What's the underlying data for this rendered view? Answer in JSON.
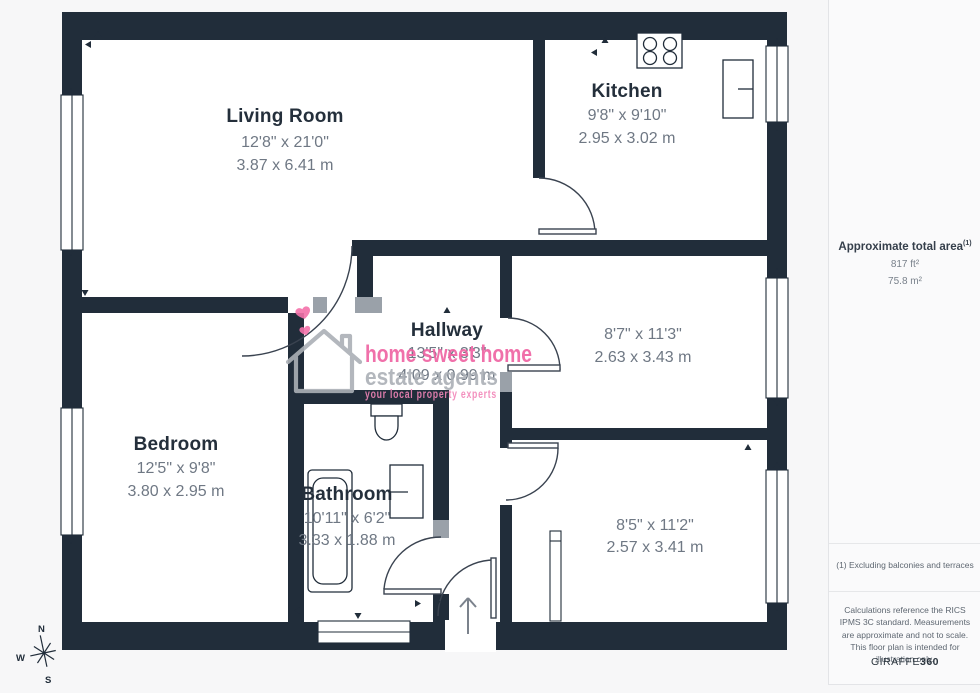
{
  "colors": {
    "wall": "#212d3a",
    "background": "#f7f7f8",
    "floor": "#ffffff",
    "dim_text": "#6f7884",
    "label_text": "#242f3b",
    "watermark_pink": "#ef61a1",
    "watermark_gray": "#abb0b6",
    "tagline_pink": "#f285b8"
  },
  "rooms": {
    "living_room": {
      "name": "Living Room",
      "imperial": "12'8\" x 21'0\"",
      "metric": "3.87 x 6.41 m"
    },
    "kitchen": {
      "name": "Kitchen",
      "imperial": "9'8\" x 9'10\"",
      "metric": "2.95 x 3.02 m"
    },
    "hallway": {
      "name": "Hallway",
      "imperial": "13'5\" x 3'3\"",
      "metric": "4.09 x 0.99 m"
    },
    "bedroom": {
      "name": "Bedroom",
      "imperial": "12'5\" x 9'8\"",
      "metric": "3.80 x 2.95 m"
    },
    "bathroom": {
      "name": "Bathroom",
      "imperial": "10'11\" x 6'2\"",
      "metric": "3.33 x 1.88 m"
    },
    "room_top_right": {
      "imperial": "8'7\" x 11'3\"",
      "metric": "2.63 x 3.43 m"
    },
    "room_bottom_right": {
      "imperial": "8'5\" x 11'2\"",
      "metric": "2.57 x 3.41 m"
    }
  },
  "watermark": {
    "brand_line1": "home sweet home",
    "brand_line2": "estate agents",
    "tagline": "your local property experts"
  },
  "compass": {
    "north": "N",
    "west": "W",
    "south": "S"
  },
  "sidebar": {
    "area_title": "Approximate total area",
    "area_note_ref": "(1)",
    "area_imperial": "817 ft²",
    "area_metric": "75.8 m²",
    "footnote": "(1) Excluding balconies and terraces",
    "disclaimer": "Calculations reference the RICS IPMS 3C standard. Measurements are approximate and not to scale. This floor plan is intended for illustration only.",
    "brand_name": "GIRAFFE",
    "brand_suffix": "360"
  }
}
